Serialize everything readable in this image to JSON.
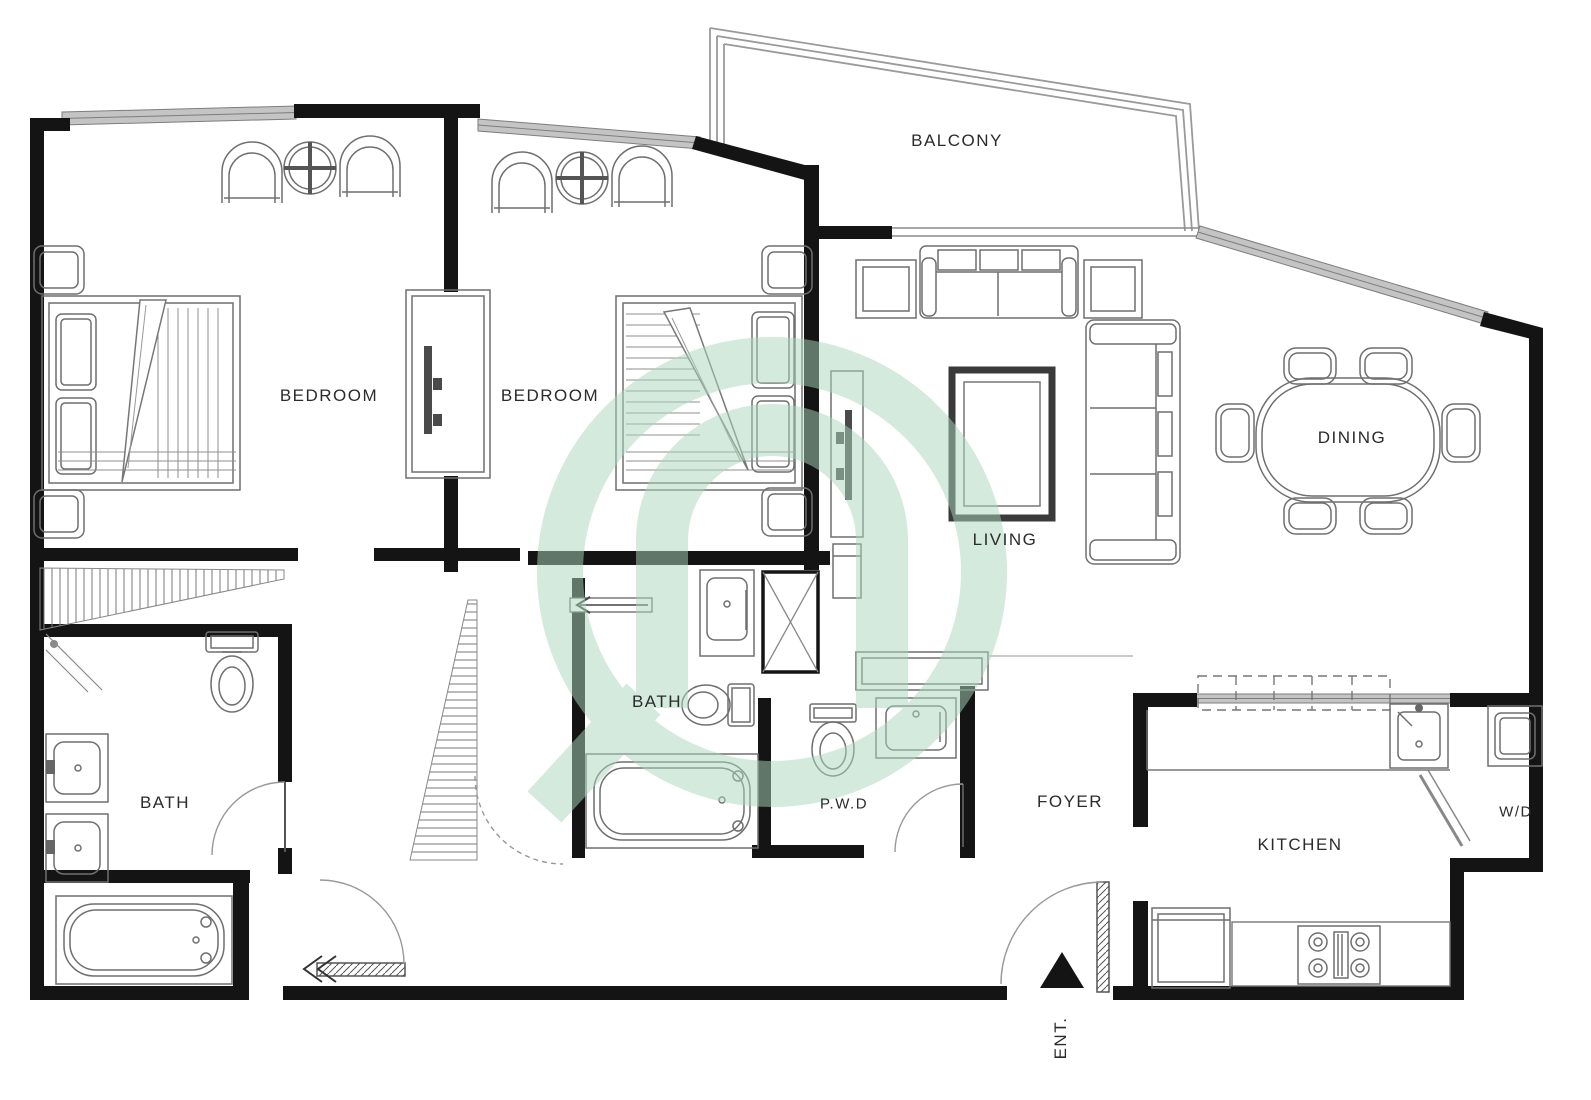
{
  "plan": {
    "type": "apartment-floor-plan",
    "rooms": {
      "balcony": {
        "label": "BALCONY"
      },
      "bedroom_1": {
        "label": "BEDROOM"
      },
      "bedroom_2": {
        "label": "BEDROOM"
      },
      "living": {
        "label": "LIVING"
      },
      "dining": {
        "label": "DINING"
      },
      "bath_1": {
        "label": "BATH"
      },
      "bath_2": {
        "label": "BATH"
      },
      "powder_room": {
        "label": "P.W.D"
      },
      "foyer": {
        "label": "FOYER"
      },
      "kitchen": {
        "label": "KITCHEN"
      },
      "washer_dryer": {
        "label": "W/D"
      },
      "entrance": {
        "label": "ENT."
      }
    },
    "colors": {
      "wall_black": "#141414",
      "furniture_gray": "#6f6f6f",
      "window_gray": "#c4c4c4",
      "watermark_green": "#a9d7bd",
      "background": "#ffffff"
    }
  }
}
